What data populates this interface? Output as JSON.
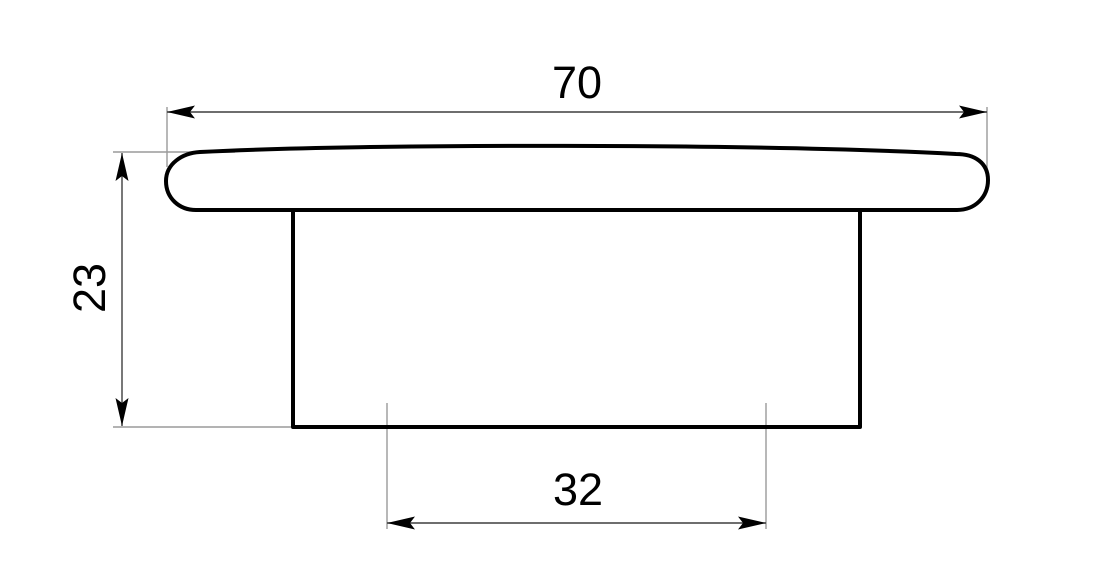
{
  "drawing": {
    "type": "technical-dimension-drawing",
    "view": "side-profile-of-cap-with-stem",
    "dimensions": {
      "overall_width": {
        "label": "70",
        "value": 70,
        "orientation": "horizontal",
        "location": "top"
      },
      "overall_height": {
        "label": "23",
        "value": 23,
        "orientation": "vertical",
        "location": "left"
      },
      "inner_width": {
        "label": "32",
        "value": 32,
        "orientation": "horizontal",
        "location": "bottom"
      }
    },
    "colors": {
      "background": "#ffffff",
      "object_line": "#000000",
      "dimension_line": "#3f3f3f",
      "extension_line": "#9a9a9a",
      "dimension_arrow": "#000000",
      "text": "#000000"
    }
  }
}
